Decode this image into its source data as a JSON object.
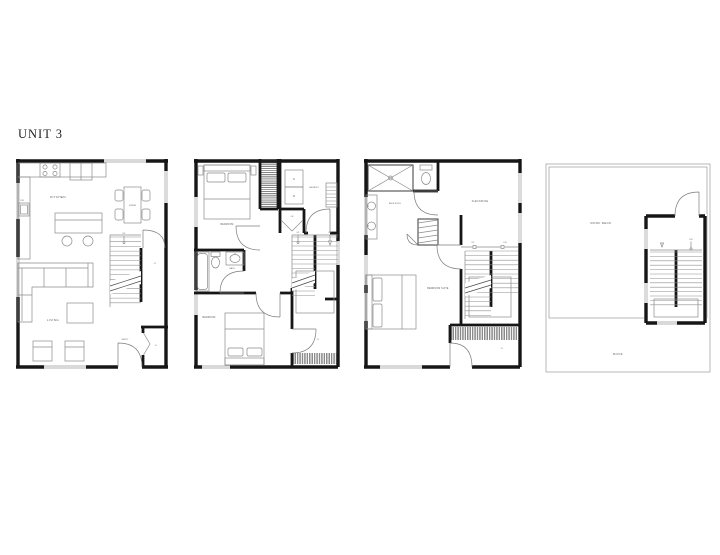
{
  "sheet": {
    "title": "UNIT 3"
  },
  "colors": {
    "wall": "#161616",
    "fixture_line": "#8b8b8b",
    "label_text": "#5a5a5a",
    "background": "#ffffff"
  },
  "plans": {
    "main": {
      "kitchen": "KITCHEN",
      "dining": "DINING",
      "living": "LIVING",
      "entry": "ENTRY",
      "up": "UP",
      "stair_closet": "CL",
      "entry_closet": "CL",
      "dw": "DW"
    },
    "second": {
      "bedroom_front": "BEDROOM",
      "laundry": "LAUNDRY",
      "dryer": "D",
      "washer": "W",
      "linen": "LN",
      "bath": "BATH",
      "bedroom_rear": "BEDROOM",
      "up": "UP",
      "dn": "DN",
      "closet": "CL"
    },
    "third": {
      "bath_suite": "BATH SUITE",
      "flex_office": "FLEX/OFFICE",
      "bedroom_suite": "BEDROOM SUITE",
      "up": "UP",
      "dn": "DN",
      "closet": "CL"
    },
    "roof": {
      "roof_deck": "ROOF DECK",
      "roof": "ROOF",
      "dn": "DN"
    }
  }
}
